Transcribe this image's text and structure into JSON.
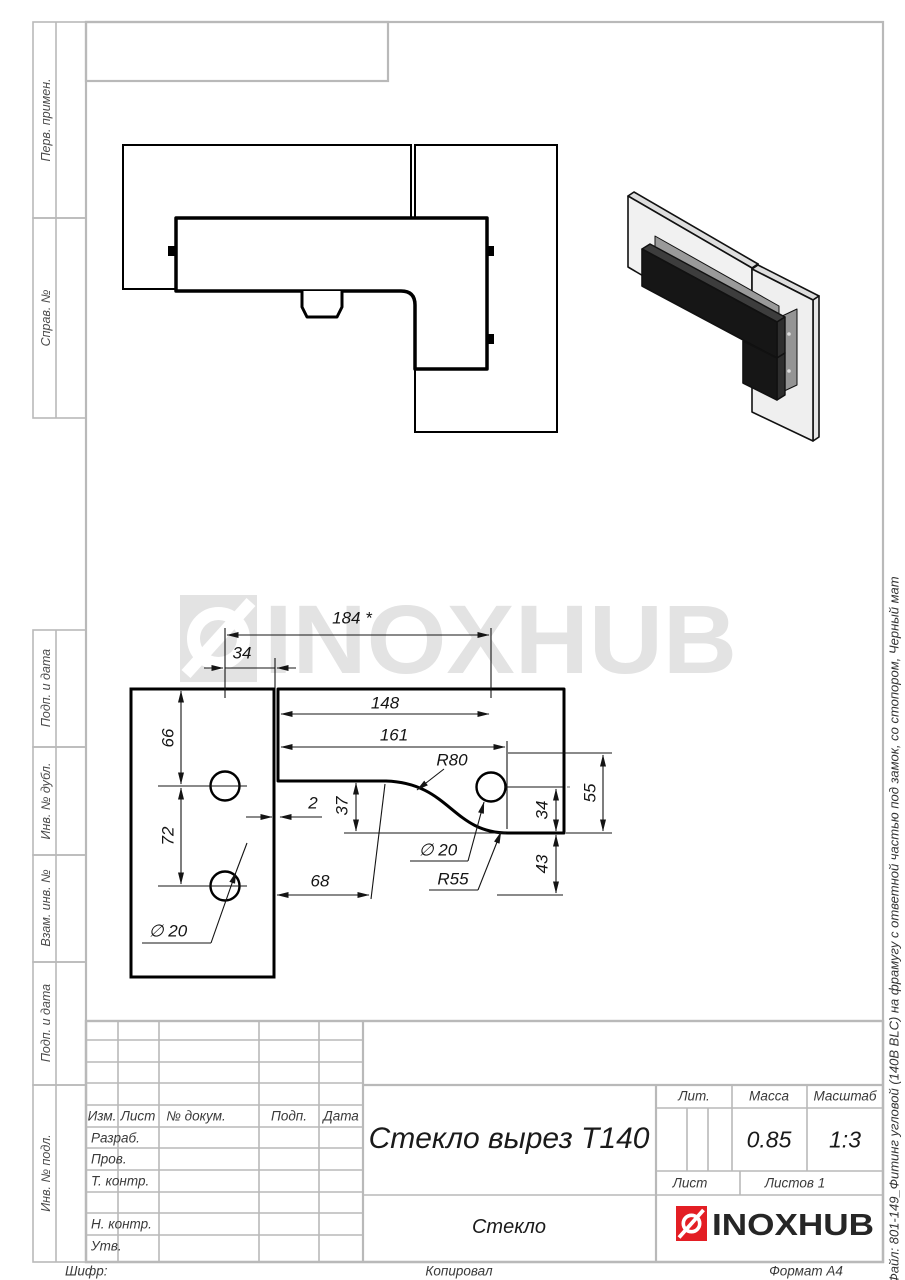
{
  "sheet": {
    "watermark_text": "INOXHUB",
    "file_note": "Файл: 801-149_Фитинг угловой (140В BLC) на фрамугу с ответной частью под замок, со стопором, Черный мат",
    "footer": {
      "code_label": "Шифр:",
      "copied_label": "Копировал",
      "format_label": "Формат А4"
    }
  },
  "side_labels": {
    "perv_primen": "Перв. примен.",
    "sprav_no": "Справ. №",
    "podp_data_1": "Подп. и дата",
    "inv_dubl": "Инв. № дубл.",
    "vzam_inv": "Взам. инв. №",
    "podp_data_2": "Подп. и дата",
    "inv_podl": "Инв. № подл."
  },
  "title_block": {
    "headers": {
      "izm": "Изм.",
      "list": "Лист",
      "doc_no": "№ докум.",
      "podp": "Подп.",
      "data": "Дата"
    },
    "rows": {
      "razrab": "Разраб.",
      "prov": "Пров.",
      "t_kontr": "Т. контр.",
      "n_kontr": "Н. контр.",
      "utv": "Утв."
    },
    "title": "Стекло вырез Т140",
    "material": "Стекло",
    "lit_label": "Лит.",
    "mass_label": "Масса",
    "scale_label": "Масштаб",
    "mass_value": "0.85",
    "scale_value": "1:3",
    "sheet_label": "Лист",
    "sheets_label": "Листов 1",
    "logo_text": "INOXHUB"
  },
  "dimensions": {
    "d184": "184 *",
    "d34_top": "34",
    "d148": "148",
    "d161": "161",
    "r80": "R80",
    "d66": "66",
    "d72": "72",
    "d2": "2",
    "d37": "37",
    "d34_right": "34",
    "d55": "55",
    "d43": "43",
    "d68": "68",
    "dia20_left": "∅ 20",
    "dia20_right": "∅ 20",
    "r55": "R55"
  },
  "colors": {
    "brand_red": "#e31e24",
    "watermark_gray": "#e3e3e3",
    "form_line": "#b9b9b9"
  }
}
